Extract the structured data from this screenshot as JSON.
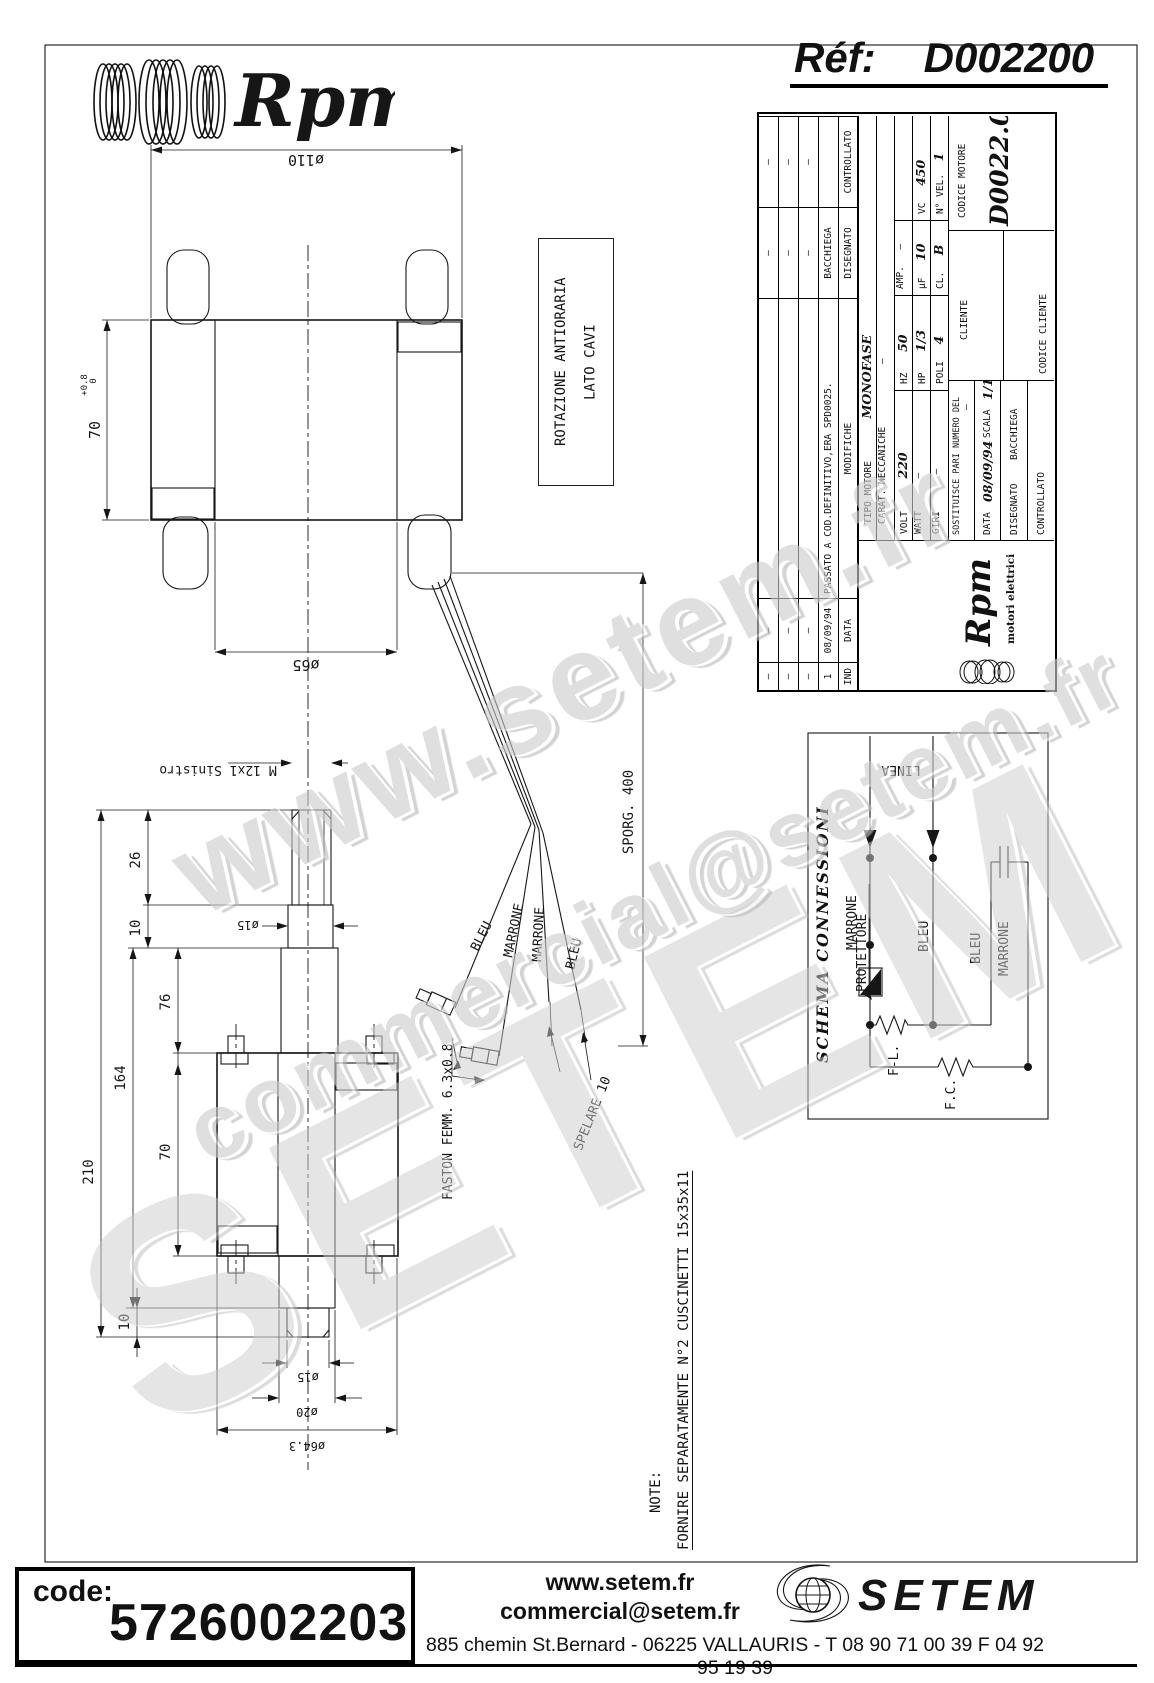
{
  "header": {
    "brand": "Rpm",
    "ref_label": "Réf:",
    "ref_value": "D002200"
  },
  "watermarks": {
    "w1": "www.setem.fr",
    "w2": "SETEM",
    "w3": "commercial@setem.fr"
  },
  "annotations": {
    "rotation_line1": "ROTAZIONE ANTIORARIA",
    "rotation_line2": "LATO CAVI",
    "thread": "M 12x1 Sinistro",
    "sporg": "SPORG. 400",
    "spelare": "SPELARE 10",
    "faston": "FASTON FEMM. 6.3x0.8",
    "note_label": "NOTE:",
    "note_text": "FORNIRE SEPARATAMENTE N°2 CUSCINETTI 15x35x11"
  },
  "dims": {
    "d110": "ø110",
    "h70": "70",
    "h70_tol_plus": "+0.8",
    "h70_tol_zero": "0",
    "d65": "ø65",
    "l26": "26",
    "l10_top": "10",
    "l76": "76",
    "l70": "70",
    "l164": "164",
    "l210": "210",
    "l10_bot": "10",
    "d15_neck": "ø15",
    "d15_bot": "ø15",
    "d20": "ø20",
    "d64": "ø64.3"
  },
  "wires": {
    "w1": "BLEU",
    "w2": "MARRONE",
    "w3": "MARRONE",
    "w4": "BLEU"
  },
  "schema": {
    "title": "SCHEMA CONNESSIONI",
    "linea": "LINEA",
    "marrone_in": "MARRONE",
    "protettore": "PROTETTORE",
    "bleu_in": "BLEU",
    "bleu_aux": "BLEU",
    "marrone_aux": "MARRONE",
    "fl": "F-L.",
    "fc": "F.C."
  },
  "titleblock": {
    "rev_rows": [
      {
        "no": "–",
        "data": "–",
        "mod": "",
        "dis": "–",
        "ctrl": "–"
      },
      {
        "no": "–",
        "data": "–",
        "mod": "",
        "dis": "–",
        "ctrl": "–"
      },
      {
        "no": "–",
        "data": "–",
        "mod": "",
        "dis": "–",
        "ctrl": "–"
      }
    ],
    "rev_entry": {
      "no": "1",
      "data": "08/09/94",
      "mod": "PASSATO A COD.DEFINITIVO,ERA SPD0025.",
      "dis": "BACCHIEGA",
      "ctrl": ""
    },
    "rev_header": {
      "no": "IND",
      "data": "DATA",
      "mod": "MODIFICHE",
      "dis": "DISEGNATO",
      "ctrl": "CONTROLLATO"
    },
    "tipo_label": "TIPO MOTORE",
    "tipo_value": "MONOFASE",
    "carat_label": "CARAT. MECCANICHE",
    "carat_value": "–",
    "volt_label": "VOLT",
    "volt_value": "220",
    "hz_label": "HZ",
    "hz_value": "50",
    "amp_label": "AMP.",
    "amp_value": "–",
    "watt_label": "WATT",
    "watt_value": "–",
    "hp_label": "HP",
    "hp_value": "1/3",
    "uf_label": "µF",
    "uf_value": "10",
    "vc_label": "VC",
    "vc_value": "450",
    "giri_label": "GIRI",
    "giri_value": "–",
    "poli_label": "POLI",
    "poli_value": "4",
    "cl_label": "CL.",
    "cl_value": "B",
    "nvel_label": "N° VEL.",
    "nvel_value": "1",
    "cliente_label": "CLIENTE",
    "codice_cliente_label": "CODICE CLIENTE",
    "codice_motore_label": "CODICE MOTORE",
    "codice_motore_value": "D0022.00",
    "sost_label": "SOSTITUISCE PARI NUMERO DEL",
    "sost_value": "–",
    "data_label": "DATA",
    "data_value": "08/09/94",
    "scala_label": "SCALA",
    "scala_value": "1/1",
    "disegnato_label": "DISEGNATO",
    "disegnato_value": "BACCHIEGA",
    "controllato_label": "CONTROLLATO",
    "brand": "Rpm",
    "brand_sub": "motori elettrici"
  },
  "footer": {
    "code_label": "code:",
    "code_value": "5726002203",
    "site": "www.setem.fr",
    "email": "commercial@setem.fr",
    "address": "885 chemin St.Bernard  -  06225 VALLAURIS  -  T 08 90 71 00 39   F 04 92 95 19 39",
    "brand": "SETEM"
  }
}
